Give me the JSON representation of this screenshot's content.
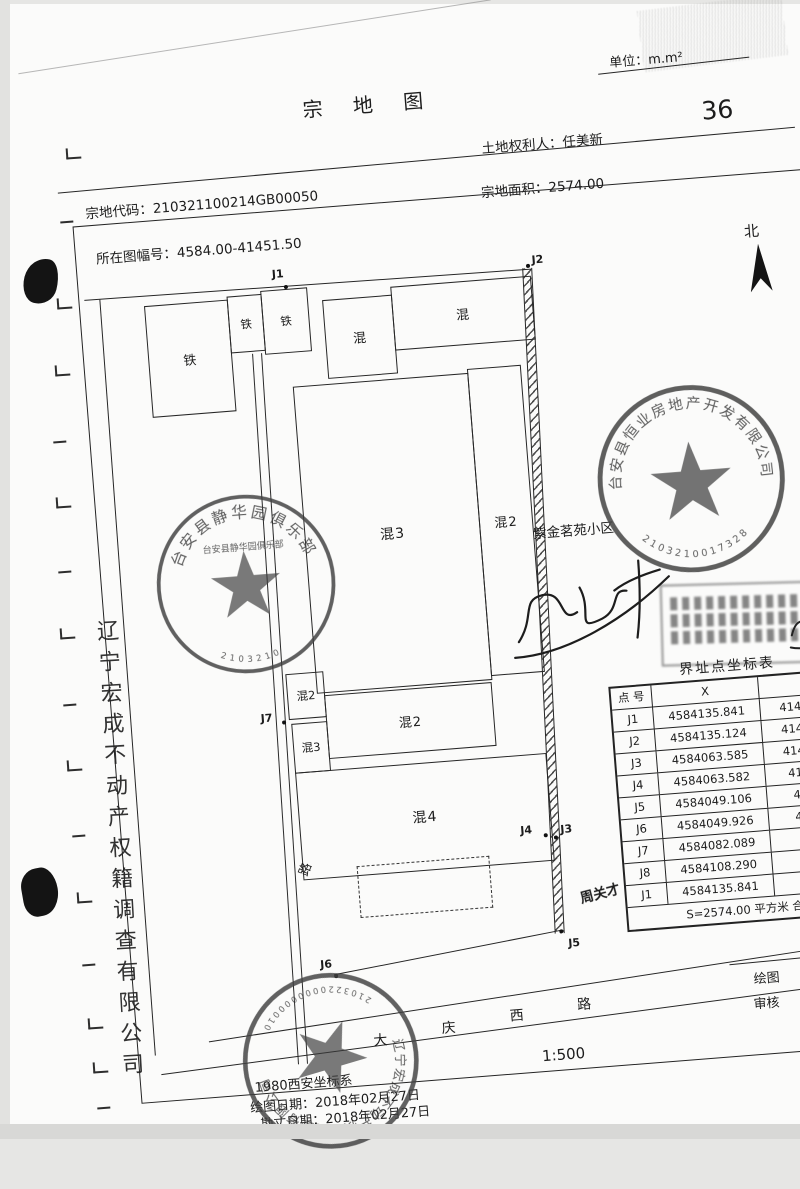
{
  "scan": {
    "page_number": "36"
  },
  "header": {
    "unit": "单位：m.m²",
    "title": "宗  地  图",
    "landholder": "土地权利人：任美新",
    "parcel_code": "宗地代码：210321100214GB00050",
    "parcel_area": "宗地面积：2574.00",
    "sheet_no": "所在图幅号：4584.00-41451.50",
    "north": "北"
  },
  "map": {
    "buildings": [
      "铁",
      "铁",
      "铁",
      "混",
      "混",
      "混3",
      "混2",
      "混2",
      "混2",
      "混3",
      "混4"
    ],
    "points": [
      "J1",
      "J2",
      "J3",
      "J4",
      "J5",
      "J6",
      "J7"
    ],
    "road_label": "路",
    "road_name": [
      "大",
      "庆",
      "西",
      "路"
    ],
    "scale": "1:500",
    "community": "紫金茗苑小区",
    "handwriting": "周关才"
  },
  "table": {
    "title": "界址点坐标表",
    "columns": [
      "点 号",
      "X",
      "Y"
    ],
    "rows": [
      {
        "id": "J1",
        "x": "4584135.841",
        "y": "41451482.048"
      },
      {
        "id": "J2",
        "x": "4584135.124",
        "y": "41451511.847"
      },
      {
        "id": "J3",
        "x": "4584063.585",
        "y": "41451509.679"
      },
      {
        "id": "J4",
        "x": "4584063.582",
        "y": "41451509.76"
      },
      {
        "id": "J5",
        "x": "4584049.106",
        "y": "41451509.2"
      },
      {
        "id": "J6",
        "x": "4584049.926",
        "y": "41451479.4"
      },
      {
        "id": "J7",
        "x": "4584082.089",
        "y": "41451480"
      },
      {
        "id": "J8",
        "x": "4584108.290",
        "y": "41451481"
      },
      {
        "id": "J1",
        "x": "4584135.841",
        "y": "41451482"
      }
    ],
    "footer": "S=2574.00 平方米 合"
  },
  "stamps": {
    "club": {
      "name": "台安县静华园俱乐部",
      "number": "2103210"
    },
    "developer": {
      "name": "台安县恒业房地产开发有限公司",
      "number": "2103210017328"
    },
    "surveyor": {
      "name": "辽宁宏成不动产权籍调查有限公司",
      "number": "2103220000000010"
    }
  },
  "margin": {
    "company_vertical": "辽宁宏成不动产权籍调查有限公司"
  },
  "footnotes": {
    "coord_system": "1980西安坐标系",
    "draw_date": "绘图日期：2018年02月27日",
    "survey_date": "勘丈日期：2018年02月27日",
    "drafter": "绘图",
    "checker": "审核"
  }
}
